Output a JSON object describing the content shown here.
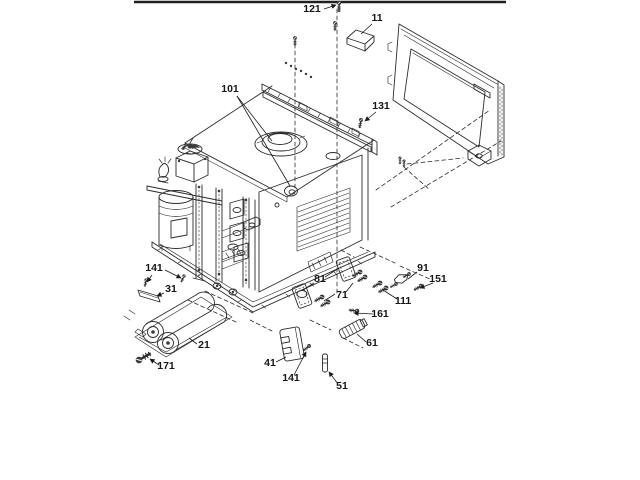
{
  "page": {
    "background": "#ffffff",
    "top_border_color": "#1d221d"
  },
  "diagram": {
    "title": "exploded-parts-diagram",
    "style": "black-and-white line art, isometric exploded view of oven chassis with outer wrapper panel and fastener hardware",
    "callouts": [
      {
        "label": "121",
        "x": 312,
        "y": 12
      },
      {
        "label": "11",
        "x": 377,
        "y": 21
      },
      {
        "label": "101",
        "x": 230,
        "y": 92
      },
      {
        "label": "131",
        "x": 381,
        "y": 109
      },
      {
        "label": "141",
        "x": 154,
        "y": 271
      },
      {
        "label": "31",
        "x": 171,
        "y": 292
      },
      {
        "label": "21",
        "x": 204,
        "y": 348
      },
      {
        "label": "171",
        "x": 166,
        "y": 369
      },
      {
        "label": "41",
        "x": 270,
        "y": 366
      },
      {
        "label": "141",
        "x": 291,
        "y": 381
      },
      {
        "label": "51",
        "x": 342,
        "y": 389
      },
      {
        "label": "61",
        "x": 372,
        "y": 346
      },
      {
        "label": "161",
        "x": 380,
        "y": 317
      },
      {
        "label": "71",
        "x": 342,
        "y": 298
      },
      {
        "label": "81",
        "x": 320,
        "y": 282
      },
      {
        "label": "111",
        "x": 403,
        "y": 304
      },
      {
        "label": "91",
        "x": 423,
        "y": 271
      },
      {
        "label": "151",
        "x": 438,
        "y": 282
      }
    ]
  }
}
